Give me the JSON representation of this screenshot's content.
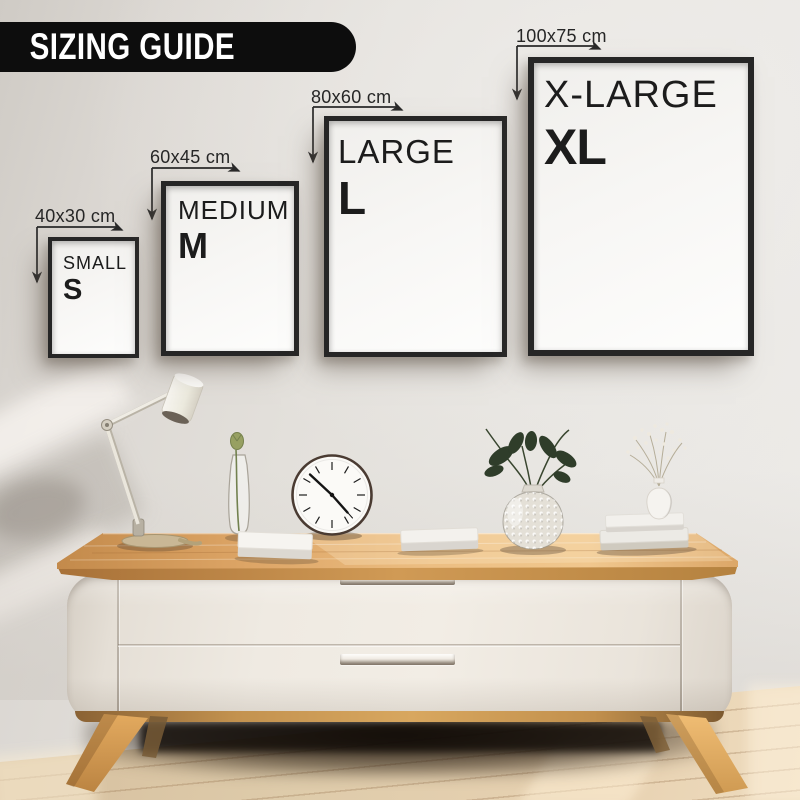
{
  "banner": {
    "label": "SIZING GUIDE"
  },
  "frames": [
    {
      "size": "small",
      "name": "SMALL",
      "letter": "S",
      "dimensions": "40x30 cm"
    },
    {
      "size": "medium",
      "name": "MEDIUM",
      "letter": "M",
      "dimensions": "60x45 cm"
    },
    {
      "size": "large",
      "name": "LARGE",
      "letter": "L",
      "dimensions": "80x60 cm"
    },
    {
      "size": "x-large",
      "name": "X-LARGE",
      "letter": "XL",
      "dimensions": "100x75 cm"
    }
  ],
  "colors": {
    "banner_bg": "#0d0d0d",
    "banner_text": "#ffffff",
    "frame_border": "#262626",
    "label_text": "#1c1c1c",
    "dimension_text": "#262626",
    "wall": "#e3e0db",
    "tabletop_wood": "#dfa76a",
    "cabinet_body": "#ece7df",
    "leg_wood": "#d9a35c",
    "floor_wood": "#ddc4a3",
    "foliage_dark": "#2f3d2a"
  }
}
